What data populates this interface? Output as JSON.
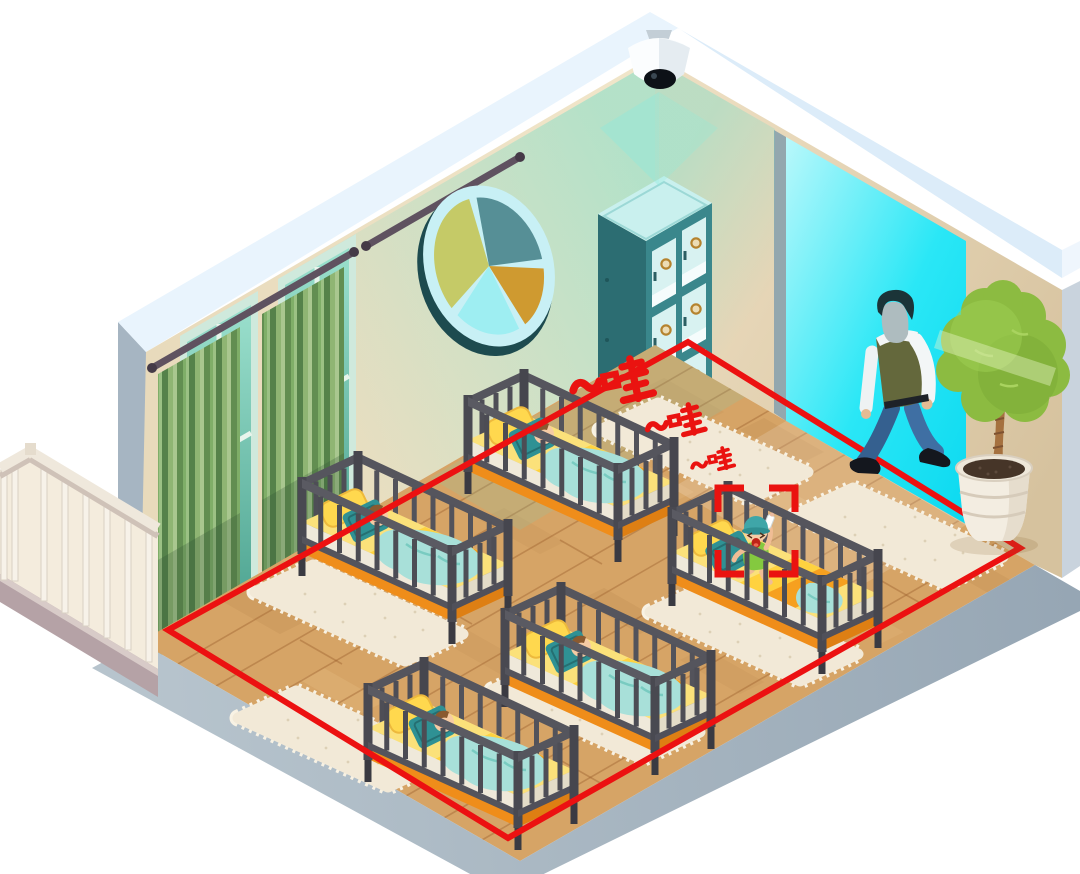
{
  "illustration": {
    "cry_alert": {
      "full_text": "~哇~哇~哇",
      "cries": [
        {
          "text": "~哇",
          "size": "large"
        },
        {
          "text": "~哇",
          "size": "medium"
        },
        {
          "text": "~哇",
          "size": "small"
        }
      ],
      "color": "#ea1310"
    },
    "detection": {
      "zone_color": "#ec1111",
      "bracket_color": "#ea1310",
      "target": "crying-baby"
    },
    "counts": {
      "cribs": 5,
      "sleeping_babies": 4,
      "crying_babies": 1,
      "adults": 1,
      "rugs": 6
    },
    "colors": {
      "wall_beige": "#ead9bc",
      "wall_top_band": "#e9f4fd",
      "wall_outer": "#a6b5c2",
      "floor_wood": "#d6a466",
      "floor_slab": "#a9b7c2",
      "doorway_glow": "#0ce0f4",
      "camera_light": "#60dcc8",
      "crib_frame": "#4a4a52",
      "mattress_yellow": "#fbe17a",
      "mattress_orange": "#ef8d1a",
      "blanket_teal": "#a8e0d9",
      "pillow_teal": "#2f9194",
      "rug_cream": "#f2e9d7",
      "curtain_green": "#7fae68",
      "cabinet_teal": "#3a878c",
      "tree_green": "#8cbb41",
      "baby_outfit_green": "#84c93f"
    }
  }
}
